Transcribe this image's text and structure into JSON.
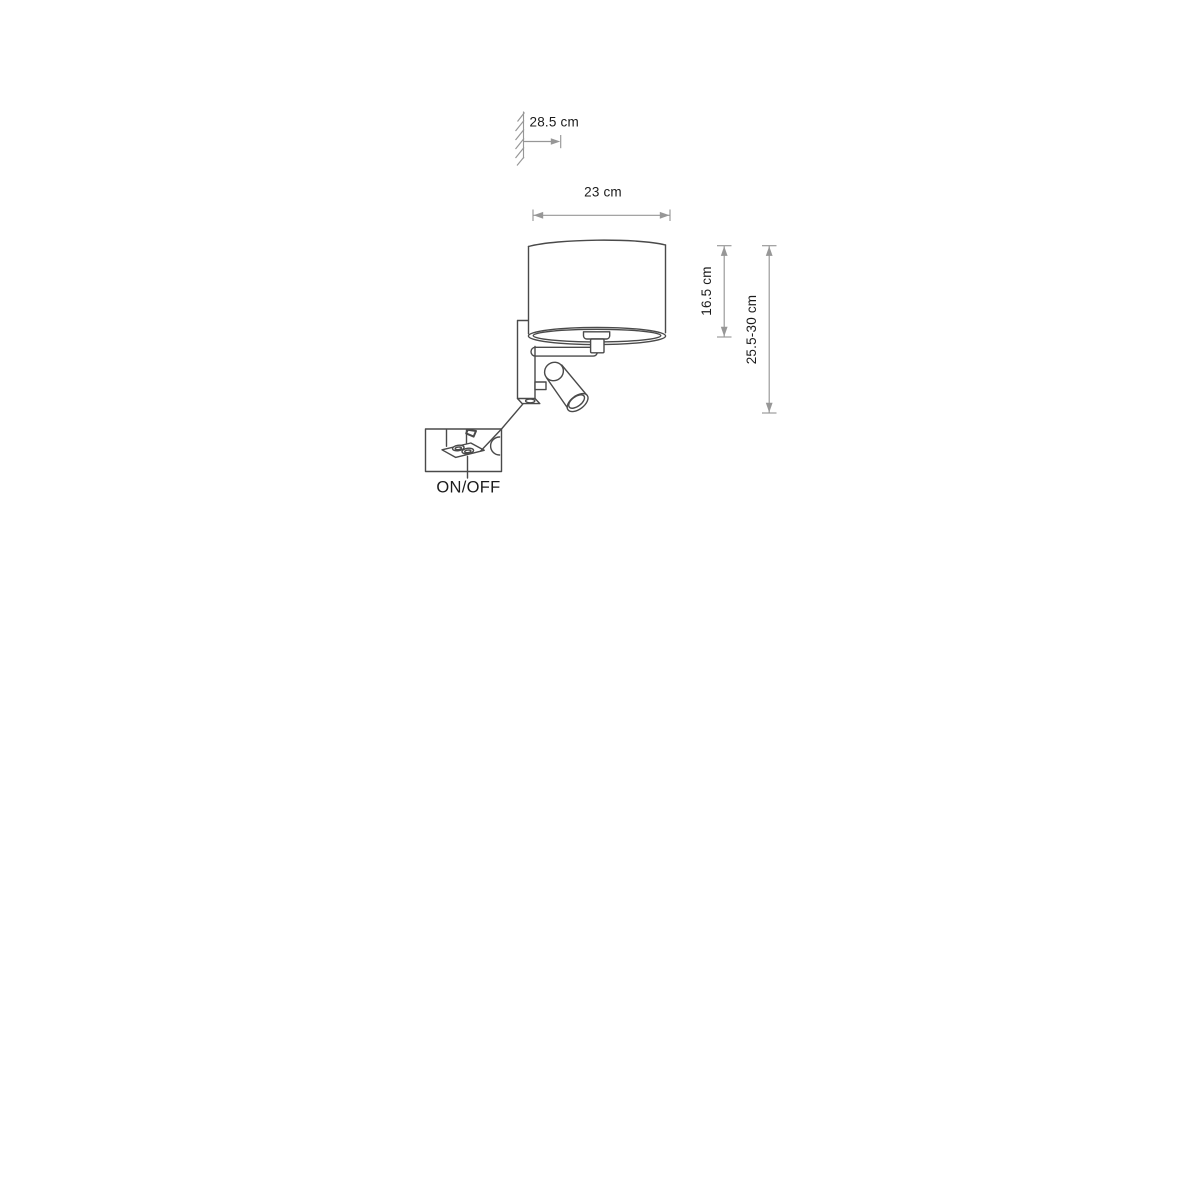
{
  "meta": {
    "type": "technical-dimension-drawing",
    "subject": "wall lamp with drum shade and adjustable reading spotlight"
  },
  "colors": {
    "background": "#ffffff",
    "drawing_line": "#4a4a4a",
    "dimension_line": "#979797",
    "text": "#1c1c1c"
  },
  "annotations": {
    "wall_offset": "28.5 cm",
    "shade_width": "23 cm",
    "shade_height": "16.5 cm",
    "overall_height": "25.5-30 cm",
    "switch_label": "ON/OFF"
  }
}
